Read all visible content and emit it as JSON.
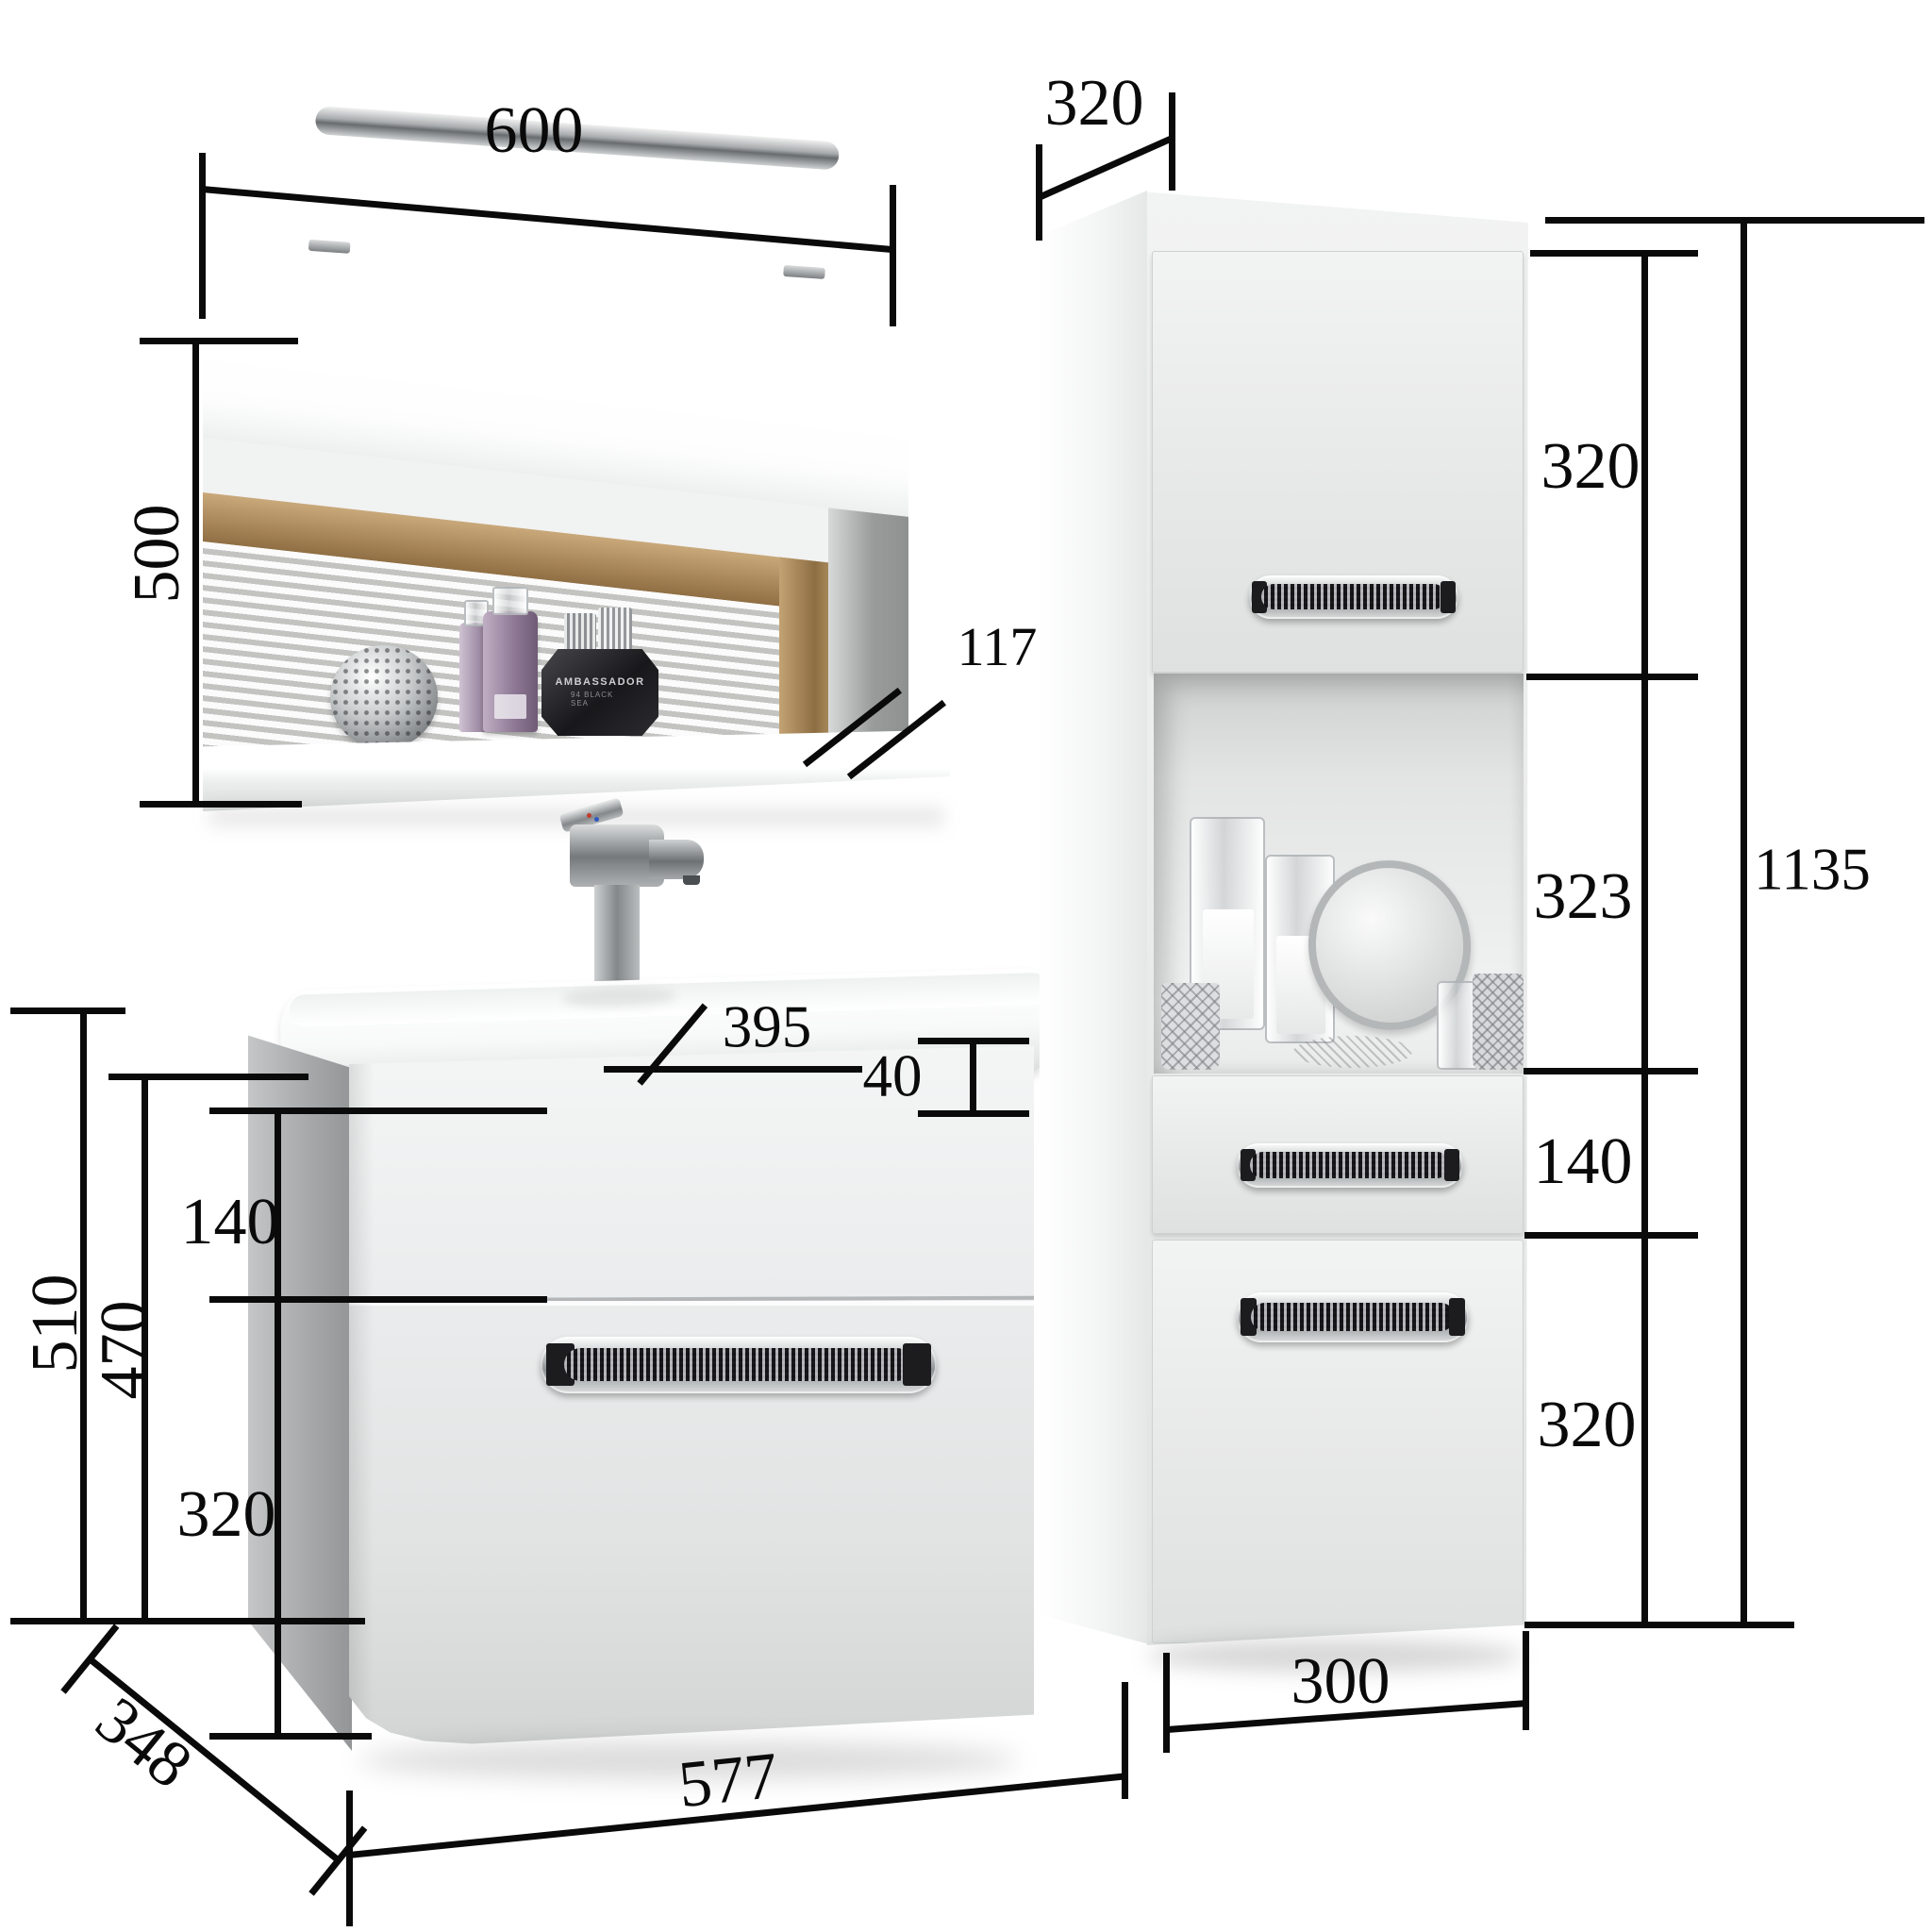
{
  "figure": {
    "type": "product-dimension-diagram",
    "subject": "Bathroom furniture set: mirror with LED lamp and shelf, wash-basin vanity with two drawers, tall side cabinet with doors, open niche and drawer",
    "units": "mm"
  },
  "annotations": {
    "mirror_width": "600",
    "mirror_height": "500",
    "mirror_shelf_depth": "117",
    "tall_cabinet_depth": "320",
    "tall_cabinet_upper_door": "320",
    "tall_cabinet_niche": "323",
    "tall_cabinet_total_height": "1135",
    "tall_cabinet_drawer": "140",
    "tall_cabinet_lower_door": "320",
    "tall_cabinet_width": "300",
    "basin_depth": "395",
    "basin_thickness": "40",
    "vanity_top_drawer": "140",
    "vanity_body_height": "470",
    "vanity_total_height": "510",
    "vanity_bottom_drawer": "320",
    "vanity_depth": "348",
    "vanity_width": "577"
  },
  "shelf_items": {
    "perfume_label_line1": "AMBASSADOR",
    "perfume_label_line2": "94 BLACK SEA"
  },
  "colors": {
    "dimension_lines": "#0a0a0a",
    "furniture_white": "#f0f1f1",
    "chrome": "#b9bcbd",
    "wood_reflection": "#b3935f",
    "background": "#ffffff"
  }
}
